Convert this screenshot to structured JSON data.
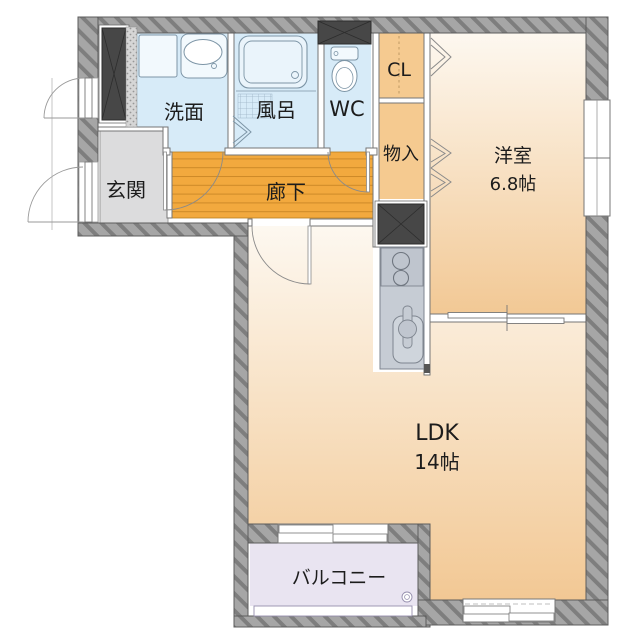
{
  "floorplan": {
    "type": "japanese-apartment-floor-plan",
    "rooms": {
      "senmen": {
        "label": "洗面"
      },
      "furo": {
        "label": "風呂"
      },
      "wc": {
        "label": "WC"
      },
      "cl": {
        "label": "CL"
      },
      "monoire": {
        "label": "物入"
      },
      "genkan": {
        "label": "玄関"
      },
      "rouka": {
        "label": "廊下"
      },
      "youshitsu": {
        "label": "洋室",
        "size": "6.8帖"
      },
      "ldk": {
        "label": "LDK",
        "size": "14帖"
      },
      "balcony": {
        "label": "バルコニー"
      }
    },
    "palette": {
      "wet_room": "#d7ebf8",
      "fixture_fill": "#f2f9fd",
      "fixture_line": "#7d95a6",
      "corridor": "#f2a93e",
      "corridor_plank": "#cd8a28",
      "closet": "#f5ca90",
      "entrance": "#dcdcdd",
      "room_top": "#fdf8f0",
      "room_bottom": "#f2c894",
      "balcony": "#e9e4f1",
      "balcony_line": "#968fae",
      "wall_base": "#a6a6a6",
      "wall_stripe": "#7e7e7e",
      "shaft": "#474747",
      "kitchen": "#c6ccd4",
      "kitchen_line": "#7e858f",
      "door_line": "#8a8a8a",
      "text": "#1c1c1c"
    }
  }
}
